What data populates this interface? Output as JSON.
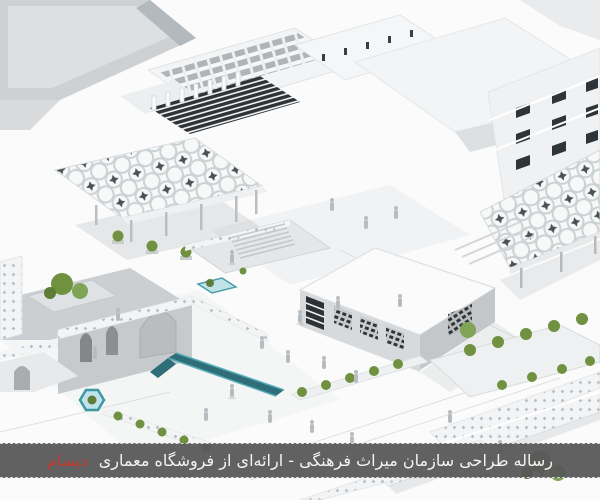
{
  "caption_bar": {
    "text": "رساله طراحی سازمان میراث فرهنگی - ارائه‌ای از فروشگاه معماری",
    "brand": "دیسام",
    "brand_color": "#c23a2e",
    "bar_color": "#585858",
    "text_color": "#f4f4f4"
  },
  "scene": {
    "description": "Isometric white architectural 3D render: cultural heritage complex with geometric star-lattice canopies, slatted facades, arched walls, courtyards, water channels, greenery and small human figures",
    "palette": {
      "background": "#fbfbfb",
      "building_white": "#f4f5f6",
      "facade_grey": "#d2d5d8",
      "slab_grey": "#c7cbce",
      "dark_glazing": "#2f3438",
      "pattern_accent": "#4b5156",
      "greenery": "#6f9140",
      "greenery_dark": "#5d7d38",
      "greenery_light": "#7fa455",
      "water_teal": "#4aa3b0",
      "water_dark": "#2f6e78",
      "water_light": "#bfe3e8",
      "figure_grey": "#b7bcc0",
      "shadow_grey": "#9aa0a4"
    }
  }
}
